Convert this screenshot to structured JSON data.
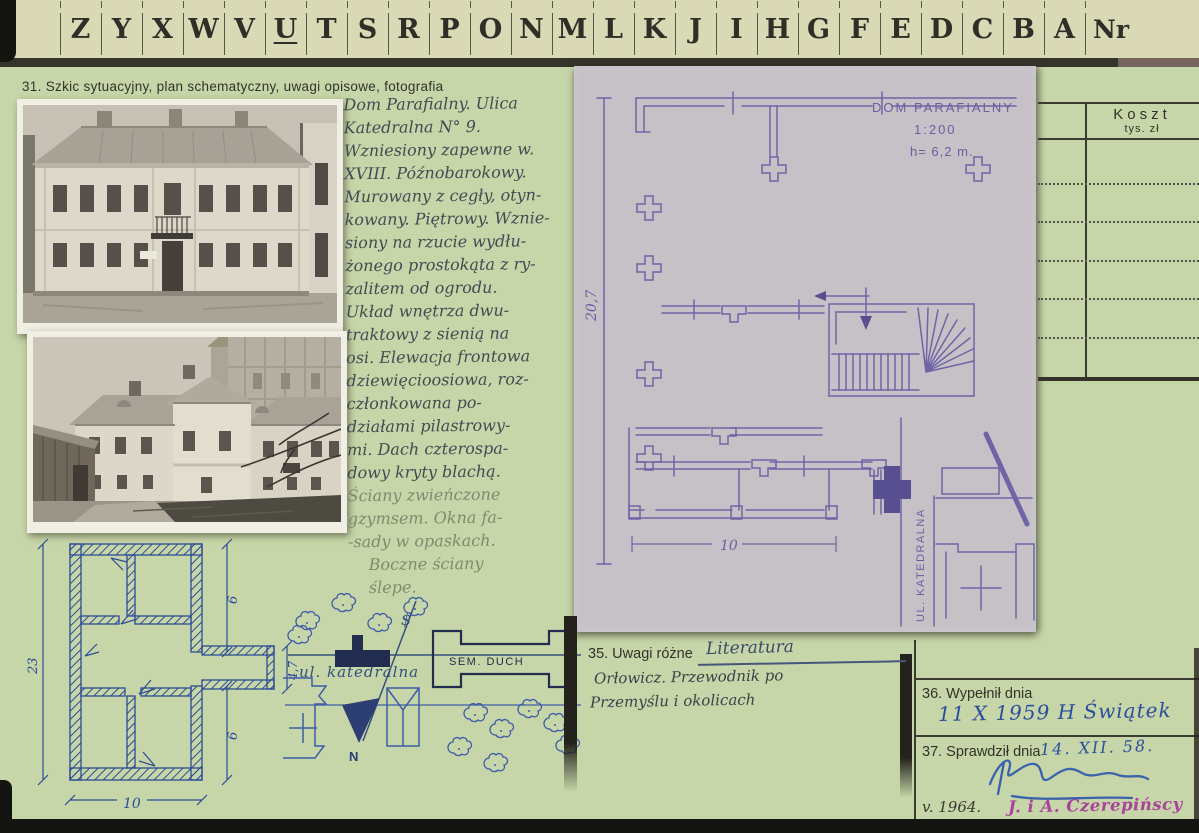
{
  "tabs": {
    "letters": [
      "Z",
      "Y",
      "X",
      "W",
      "V",
      "U",
      "T",
      "S",
      "R",
      "P",
      "O",
      "N",
      "M",
      "L",
      "K",
      "J",
      "I",
      "H",
      "G",
      "F",
      "E",
      "D",
      "C",
      "B",
      "A"
    ],
    "nr": "Nr"
  },
  "koszt": {
    "title": "Koszt",
    "unit": "tys. zł"
  },
  "section31": {
    "label": "31. Szkic sytuacyjny, plan schematyczny, uwagi opisowe, fotografia",
    "notes_ink": [
      "Dom Parafialny. Ulica",
      "Katedralna N° 9.",
      "Wzniesiony zapewne w.",
      "XVIII. Późnobarokowy.",
      "Murowany z cegły, otyn-",
      "kowany. Piętrowy. Wznie-",
      "siony na rzucie wydłu-",
      "żonego prostokąta z ry-",
      "zalitem od ogrodu.",
      "Układ wnętrza dwu-",
      "traktowy z sienią na",
      "osi. Elewacja frontowa",
      "dziewięcioosiowa, roz-",
      "członkowana po-",
      "działami pilastrowy-",
      "mi. Dach czterospa-",
      "dowy kryty blachą."
    ],
    "notes_pencil": [
      "Ściany zwieńczone",
      "gzymsem. Okna fa-",
      "-sady w opaskach.",
      "    Boczne ściany",
      "    ślepe."
    ]
  },
  "blueprint": {
    "title": "DOM PARAFIALNY",
    "scale": "1:200",
    "height_note": "h= 6,2 m.",
    "dim_vertical": "20,7",
    "dim_bottom": "10",
    "street": "UL. KATEDRALNA"
  },
  "plan_sketch": {
    "dim_left": "23",
    "dim_right_upper": "6",
    "dim_wing": "4,7",
    "dim_right_lower": "6",
    "dim_bottom": "10"
  },
  "map_sketch": {
    "seminary": "SEM. DUCH",
    "street": "ul. katedralna",
    "north": "N",
    "pole_symbol": "$"
  },
  "section35": {
    "label": "35. Uwagi różne",
    "literatura": "Literatura",
    "line1": "Orłowicz. Przewodnik po",
    "line2": "Przemyślu i okolicach"
  },
  "section36": {
    "label": "36. Wypełnił dnia",
    "value": "11 X 1959 H Świątek"
  },
  "section37": {
    "label": "37. Sprawdził dnia",
    "date": "14. XII. 58.",
    "note": "v. 1964.",
    "stamp": "J. i A. Czerepińscy"
  }
}
